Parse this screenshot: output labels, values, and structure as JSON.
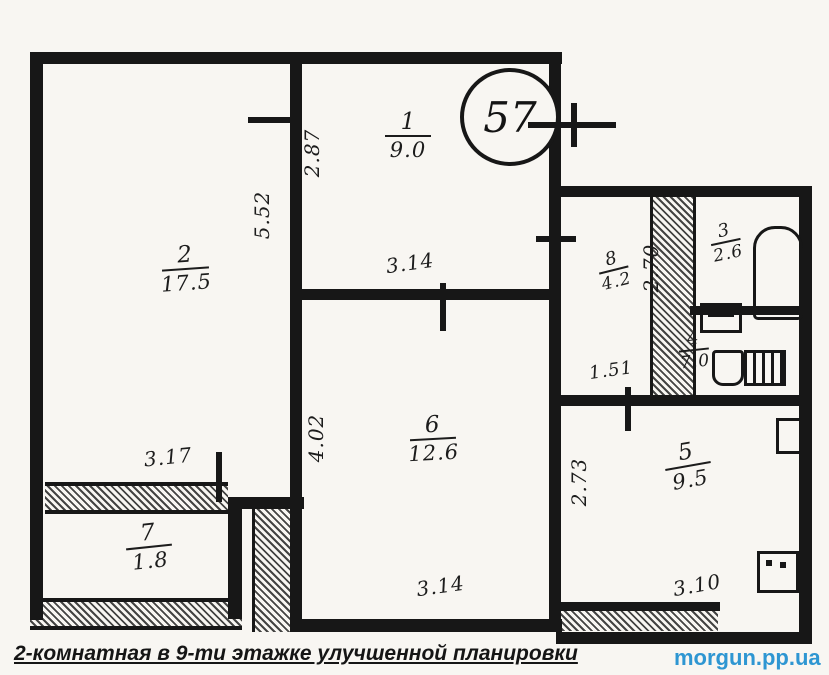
{
  "plan": {
    "apartment_number": "57",
    "rooms": [
      {
        "number": "1",
        "area": "9.0"
      },
      {
        "number": "2",
        "area": "17.5"
      },
      {
        "number": "3",
        "area": "2.6"
      },
      {
        "number": "4",
        "area": "7.0"
      },
      {
        "number": "5",
        "area": "9.5"
      },
      {
        "number": "6",
        "area": "12.6"
      },
      {
        "number": "7",
        "area": "1.8"
      },
      {
        "number": "8",
        "area": "4.2"
      }
    ],
    "dimensions": [
      {
        "value": "5.52",
        "orientation": "vertical"
      },
      {
        "value": "2.87",
        "orientation": "vertical"
      },
      {
        "value": "3.14",
        "orientation": "horizontal"
      },
      {
        "value": "2.70",
        "orientation": "vertical"
      },
      {
        "value": "1.51",
        "orientation": "horizontal"
      },
      {
        "value": "3.17",
        "orientation": "horizontal"
      },
      {
        "value": "4.02",
        "orientation": "vertical"
      },
      {
        "value": "2.73",
        "orientation": "vertical"
      },
      {
        "value": "3.14",
        "orientation": "horizontal"
      },
      {
        "value": "3.10",
        "orientation": "horizontal"
      }
    ],
    "fixtures": [
      "bathtub",
      "sink",
      "toilet",
      "radiator",
      "stove",
      "cabinet"
    ]
  },
  "footer": {
    "caption": "2-комнатная в 9-ти этажке улучшенной планировки",
    "watermark": "morgun.pp.ua"
  },
  "colors": {
    "ink": "#171717",
    "paper": "#f8f6f2",
    "watermark_blue": "#2e96d2"
  }
}
